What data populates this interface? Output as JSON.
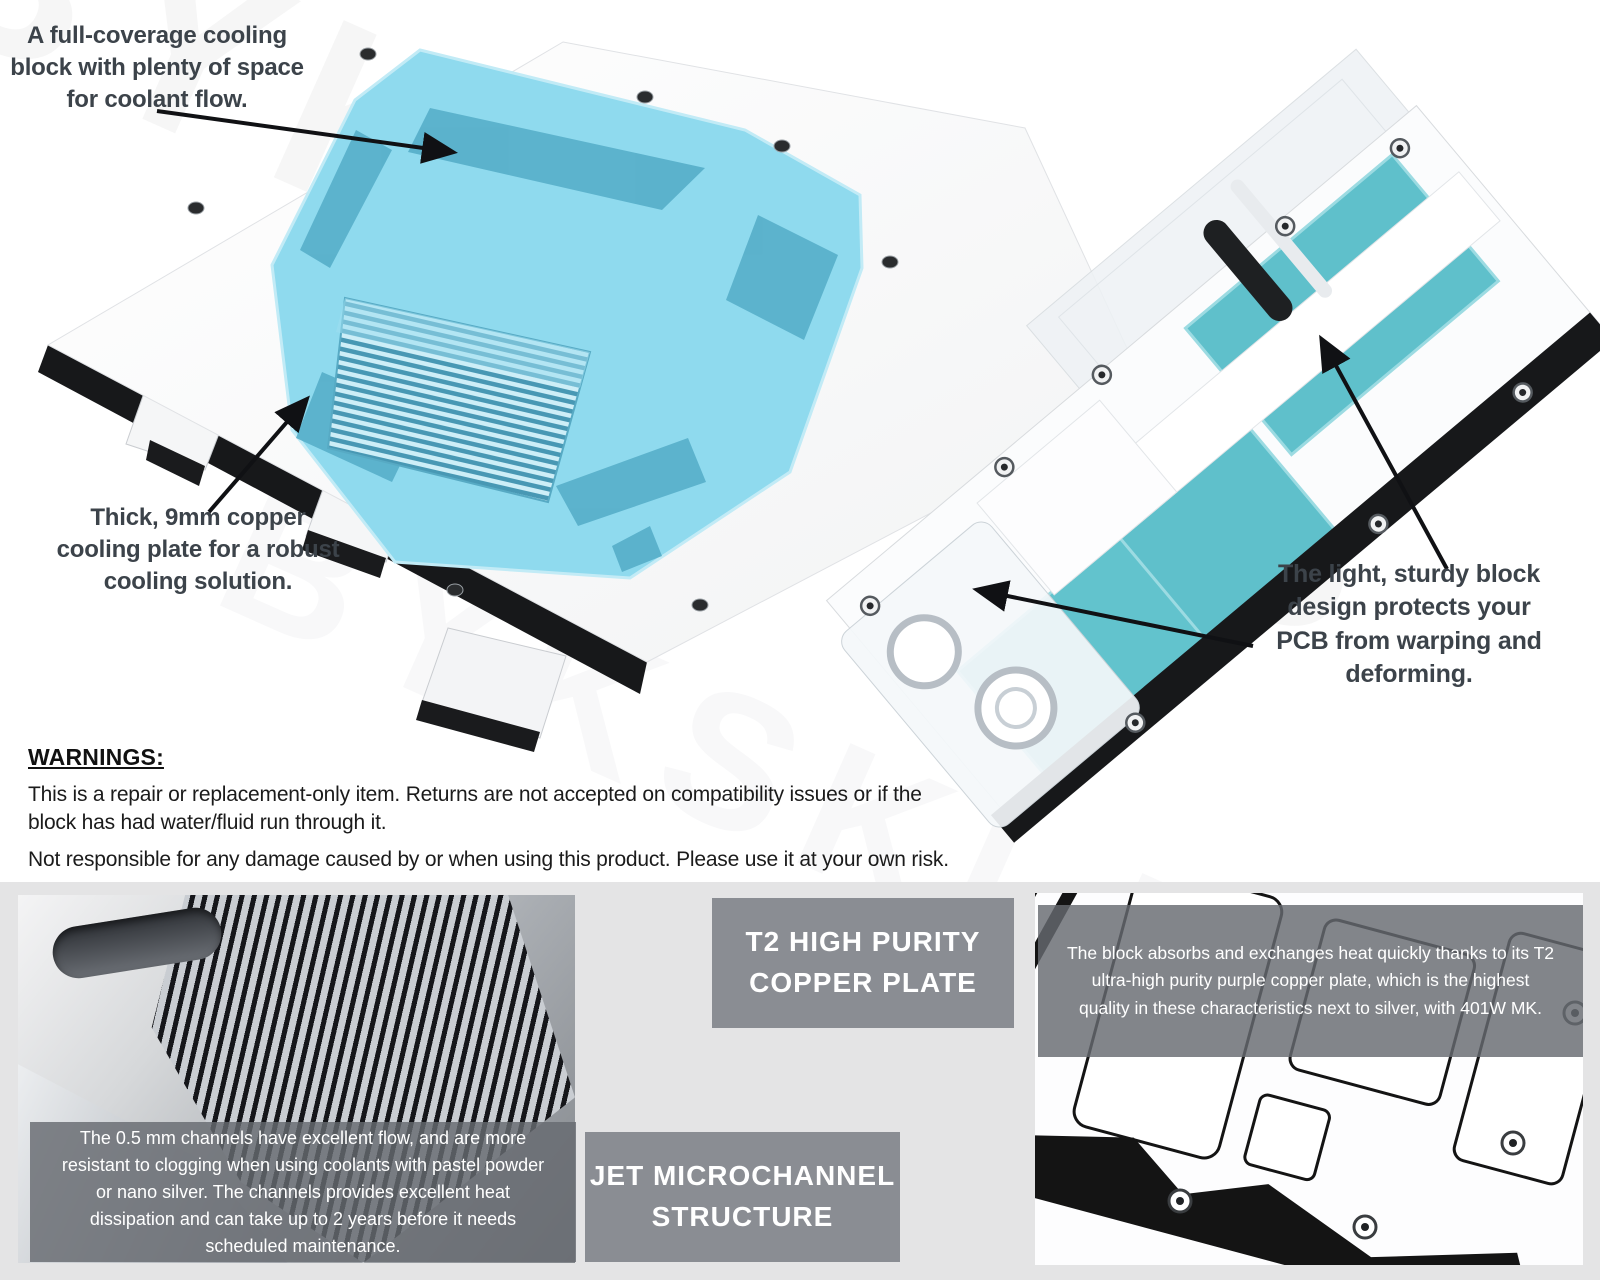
{
  "watermark": {
    "text": "BYKSKI.US"
  },
  "annotations": {
    "coolant_flow_lines": [
      "A full-coverage cooling",
      "block with plenty of space",
      "for coolant flow."
    ],
    "copper_plate_lines": [
      "Thick, 9mm copper",
      "cooling plate for a robust",
      "cooling solution."
    ],
    "block_design_lines": [
      "The light, sturdy block",
      "design protects your",
      "PCB from warping and",
      "deforming."
    ]
  },
  "warnings": {
    "heading": "WARNINGS:",
    "paragraph1_lines": [
      "This is a repair or replacement-only item. Returns are not accepted on compatibility issues or if the",
      "block has had water/fluid run through it."
    ],
    "paragraph2": "Not responsible for any damage caused by or when using this product. Please use it at your own risk."
  },
  "features": {
    "t2": {
      "title_lines": [
        "T2 HIGH PURITY",
        "COPPER PLATE"
      ],
      "description_lines": [
        "The block absorbs and exchanges heat quickly thanks to its T2",
        "ultra-high purity purple copper plate, which is the highest",
        "quality in these characteristics next to silver, with 401W MK."
      ]
    },
    "jet": {
      "title_lines": [
        "JET MICROCHANNEL",
        "STRUCTURE"
      ],
      "description_lines": [
        "The 0.5 mm channels have excellent flow, and are more",
        "resistant to clogging when using coolants with pastel powder",
        "or nano silver. The channels provides excellent heat",
        "dissipation and can take up to 2 years before it needs",
        "scheduled maintenance."
      ]
    }
  },
  "colors": {
    "acrylic_cyan": "#8fdaee",
    "cyan_shadow": "#56aec9",
    "teal_pad": "#5fc0cb",
    "panel_gray": "#8a8d93",
    "band_gray": "#e4e4e5",
    "arrow_black": "#101114",
    "caption_text": "#3c434a"
  }
}
